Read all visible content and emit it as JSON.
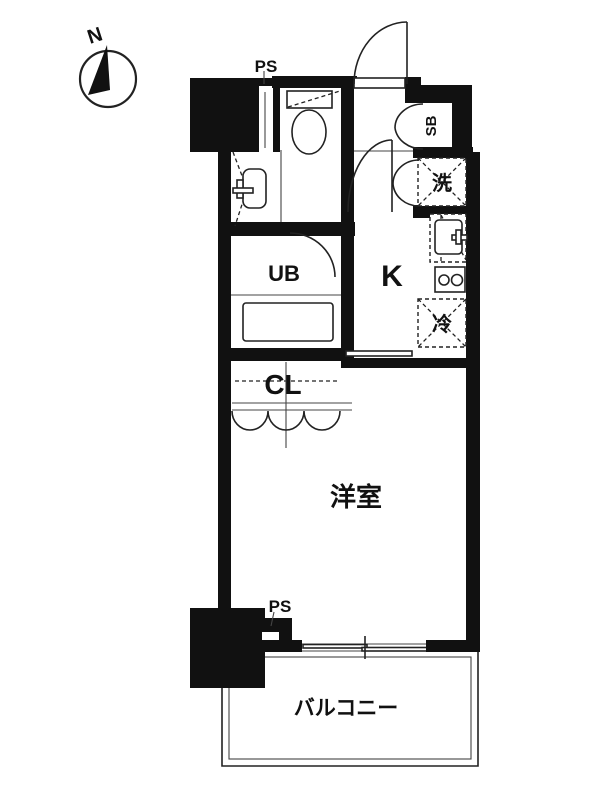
{
  "title": "1K apartment floor plan",
  "colors": {
    "wall": "#111111",
    "line": "#222222",
    "background": "#ffffff",
    "pipe_gray": "#999999"
  },
  "compass": {
    "label": "N"
  },
  "labels": {
    "ps_top": "PS",
    "shoe_box": "SB",
    "laundry": "洗",
    "unit_bath": "UB",
    "kitchen": "K",
    "refrigerator": "冷",
    "closet": "CL",
    "western_room": "洋室",
    "ps_bottom": "PS",
    "balcony": "バルコニー"
  }
}
